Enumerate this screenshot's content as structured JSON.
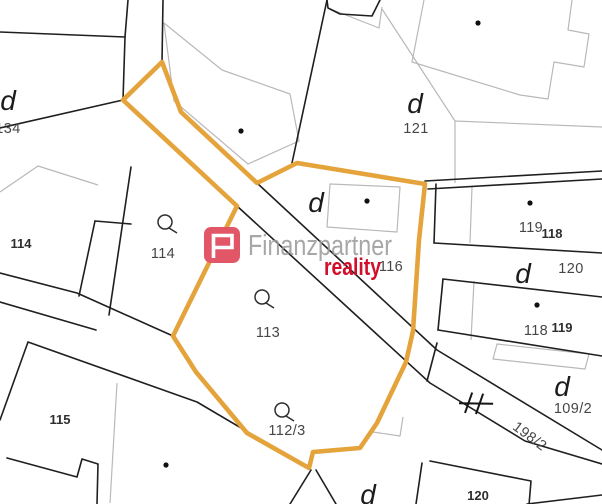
{
  "map": {
    "background": "#ffffff",
    "colors": {
      "highlight": "#E5A33C",
      "parcel_line": "#1f1f1f",
      "building_line": "#b9b9b9",
      "dot": "#101010"
    },
    "highlight_polygon": [
      [
        162,
        62
      ],
      [
        123,
        100
      ],
      [
        237,
        206
      ],
      [
        173,
        336
      ],
      [
        196,
        372
      ],
      [
        247,
        433
      ],
      [
        309,
        468
      ],
      [
        313,
        452
      ],
      [
        360,
        448
      ],
      [
        377,
        423
      ],
      [
        406,
        362
      ],
      [
        413,
        331
      ],
      [
        419,
        240
      ],
      [
        425,
        184
      ],
      [
        297,
        163
      ],
      [
        257,
        183
      ],
      [
        181,
        112
      ]
    ],
    "parcel_lines": [
      [
        [
          0,
          32
        ],
        [
          125,
          37
        ]
      ],
      [
        [
          128,
          0
        ],
        [
          125,
          37
        ],
        [
          123,
          100
        ]
      ],
      [
        [
          163,
          0
        ],
        [
          162,
          62
        ]
      ],
      [
        [
          162,
          62
        ],
        [
          181,
          112
        ],
        [
          257,
          183
        ],
        [
          437,
          350
        ],
        [
          602,
          450
        ]
      ],
      [
        [
          123,
          100
        ],
        [
          237,
          206
        ],
        [
          430,
          383
        ],
        [
          525,
          441
        ],
        [
          602,
          464
        ]
      ],
      [
        [
          123,
          100
        ],
        [
          0,
          128
        ]
      ],
      [
        [
          0,
          273
        ],
        [
          77,
          293
        ],
        [
          173,
          336
        ]
      ],
      [
        [
          0,
          302
        ],
        [
          96,
          330
        ]
      ],
      [
        [
          95,
          221
        ],
        [
          79,
          296
        ]
      ],
      [
        [
          131,
          167
        ],
        [
          109,
          315
        ]
      ],
      [
        [
          95,
          221
        ],
        [
          131,
          224
        ]
      ],
      [
        [
          0,
          420
        ],
        [
          28,
          342
        ],
        [
          197,
          402
        ],
        [
          309,
          468
        ]
      ],
      [
        [
          7,
          458
        ],
        [
          77,
          477
        ],
        [
          82,
          459
        ],
        [
          98,
          464
        ],
        [
          97,
          504
        ]
      ],
      [
        [
          311,
          470
        ],
        [
          290,
          504
        ]
      ],
      [
        [
          316,
          470
        ],
        [
          336,
          504
        ]
      ],
      [
        [
          422,
          463
        ],
        [
          416,
          504
        ]
      ],
      [
        [
          430,
          461
        ],
        [
          531,
          481
        ],
        [
          529,
          505
        ]
      ],
      [
        [
          527,
          504
        ],
        [
          602,
          495
        ]
      ],
      [
        [
          425,
          181
        ],
        [
          602,
          171
        ]
      ],
      [
        [
          428,
          189
        ],
        [
          602,
          179
        ]
      ],
      [
        [
          436,
          184
        ],
        [
          434,
          243
        ]
      ],
      [
        [
          434,
          243
        ],
        [
          602,
          253
        ]
      ],
      [
        [
          443,
          279
        ],
        [
          602,
          297
        ]
      ],
      [
        [
          443,
          279
        ],
        [
          438,
          330
        ]
      ],
      [
        [
          438,
          330
        ],
        [
          602,
          356
        ]
      ],
      [
        [
          380,
          0
        ],
        [
          372,
          16
        ],
        [
          340,
          14
        ],
        [
          328,
          8
        ],
        [
          327,
          0
        ]
      ],
      [
        [
          327,
          0
        ],
        [
          292,
          163
        ]
      ],
      [
        [
          437,
          343
        ],
        [
          427,
          381
        ]
      ]
    ],
    "building_lines": [
      {
        "points": [
          [
            0,
            192
          ],
          [
            38,
            166
          ],
          [
            98,
            185
          ]
        ],
        "closed": false
      },
      {
        "points": [
          [
            424,
            0
          ],
          [
            412,
            62
          ],
          [
            520,
            95
          ],
          [
            548,
            99
          ],
          [
            554,
            62
          ],
          [
            584,
            67
          ],
          [
            589,
            34
          ],
          [
            568,
            30
          ],
          [
            572,
            0
          ]
        ],
        "closed": false
      },
      {
        "points": [
          [
            164,
            23
          ],
          [
            222,
            70
          ],
          [
            290,
            94
          ],
          [
            299,
            141
          ],
          [
            248,
            164
          ],
          [
            174,
            101
          ]
        ],
        "closed": true
      },
      {
        "points": [
          [
            330,
            184
          ],
          [
            400,
            187
          ],
          [
            397,
            232
          ],
          [
            327,
            227
          ]
        ],
        "closed": true
      },
      {
        "points": [
          [
            497,
            344
          ],
          [
            589,
            354
          ],
          [
            585,
            369
          ],
          [
            493,
            359
          ]
        ],
        "closed": true
      },
      {
        "points": [
          [
            382,
            9
          ],
          [
            455,
            121
          ],
          [
            602,
            127
          ]
        ],
        "closed": false
      },
      {
        "points": [
          [
            455,
            121
          ],
          [
            455,
            183
          ]
        ],
        "closed": false
      },
      {
        "points": [
          [
            472,
            187
          ],
          [
            470,
            243
          ]
        ],
        "closed": false
      },
      {
        "points": [
          [
            474,
            281
          ],
          [
            471,
            340
          ]
        ],
        "closed": false
      },
      {
        "points": [
          [
            117,
            383
          ],
          [
            110,
            503
          ]
        ],
        "closed": false
      },
      {
        "points": [
          [
            328,
            8
          ],
          [
            379,
            28
          ],
          [
            382,
            7
          ]
        ],
        "closed": false
      },
      {
        "points": [
          [
            373,
            432
          ],
          [
            400,
            436
          ],
          [
            403,
            417
          ]
        ],
        "closed": false
      }
    ],
    "building_dots": [
      [
        241,
        131
      ],
      [
        367,
        201
      ],
      [
        478,
        23
      ],
      [
        530,
        203
      ],
      [
        537,
        305
      ],
      [
        166,
        465
      ]
    ],
    "landuse_symbols": [
      {
        "x": 165,
        "y": 222
      },
      {
        "x": 262,
        "y": 297
      },
      {
        "x": 282,
        "y": 410
      }
    ],
    "gate_symbol": {
      "x": 476,
      "y": 404,
      "rotate": 6
    },
    "labels": [
      {
        "text": "134",
        "x": 8,
        "y": 133,
        "style": "parcel"
      },
      {
        "text": "121",
        "x": 416,
        "y": 133,
        "style": "parcel"
      },
      {
        "text": "119",
        "x": 531,
        "y": 232,
        "style": "parcel"
      },
      {
        "text": "118",
        "x": 552,
        "y": 238,
        "style": "house"
      },
      {
        "text": "120",
        "x": 571,
        "y": 273,
        "style": "parcel"
      },
      {
        "text": "118",
        "x": 536,
        "y": 335,
        "style": "parcel"
      },
      {
        "text": "119",
        "x": 562,
        "y": 332,
        "style": "house"
      },
      {
        "text": "116",
        "x": 391,
        "y": 271,
        "style": "parcel"
      },
      {
        "text": "109/2",
        "x": 573,
        "y": 413,
        "style": "parcel"
      },
      {
        "text": "114",
        "x": 163,
        "y": 258,
        "style": "parcel"
      },
      {
        "text": "113",
        "x": 268,
        "y": 337,
        "style": "parcel"
      },
      {
        "text": "112/3",
        "x": 287,
        "y": 435,
        "style": "parcel"
      },
      {
        "text": "114",
        "x": 21,
        "y": 248,
        "style": "house"
      },
      {
        "text": "115",
        "x": 60,
        "y": 424,
        "style": "house"
      },
      {
        "text": "120",
        "x": 478,
        "y": 500,
        "style": "house"
      },
      {
        "text": "198/2",
        "x": 527,
        "y": 440,
        "style": "parcel",
        "rotate": 37
      },
      {
        "text": "d",
        "x": 8,
        "y": 110,
        "style": "d"
      },
      {
        "text": "d",
        "x": 415,
        "y": 113,
        "style": "d"
      },
      {
        "text": "d",
        "x": 316,
        "y": 212,
        "style": "d"
      },
      {
        "text": "d",
        "x": 523,
        "y": 283,
        "style": "d"
      },
      {
        "text": "d",
        "x": 562,
        "y": 396,
        "style": "d"
      },
      {
        "text": "d",
        "x": 368,
        "y": 504,
        "style": "d"
      }
    ]
  },
  "watermark": {
    "brand": "Finanzpartner",
    "brand_color": "#9b9b9b",
    "sub": "reality",
    "sub_color": "#D10F2A",
    "icon_color": "#E25768"
  }
}
